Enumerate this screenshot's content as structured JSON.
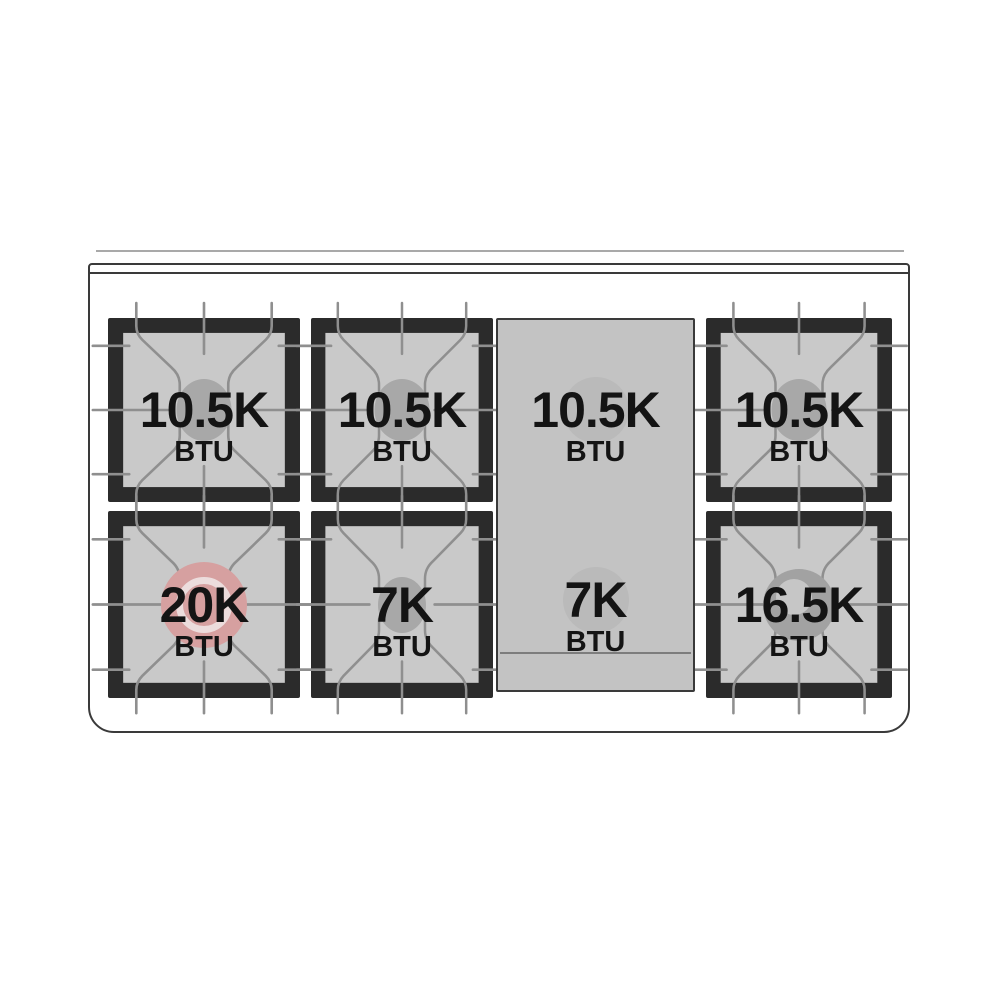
{
  "diagram": {
    "kind": "gas-range-cooktop-burner-layout",
    "unit_label": "BTU"
  },
  "burners": {
    "left_rear": {
      "value": "10.5K",
      "unit": "BTU",
      "style": "standard-cap"
    },
    "center_rear": {
      "value": "10.5K",
      "unit": "BTU",
      "style": "standard-cap"
    },
    "griddle_rear": {
      "value": "10.5K",
      "unit": "BTU",
      "style": "griddle"
    },
    "right_rear": {
      "value": "10.5K",
      "unit": "BTU",
      "style": "standard-cap"
    },
    "left_front": {
      "value": "20K",
      "unit": "BTU",
      "style": "dual-ring-pink"
    },
    "center_front": {
      "value": "7K",
      "unit": "BTU",
      "style": "standard-cap"
    },
    "griddle_front": {
      "value": "7K",
      "unit": "BTU",
      "style": "griddle"
    },
    "right_front": {
      "value": "16.5K",
      "unit": "BTU",
      "style": "ring-gray"
    }
  },
  "colors": {
    "grate_black": "#2b2b2b",
    "grate_plate_gray": "#c9c9c9",
    "griddle_gray": "#c3c3c3",
    "finger_line_gray": "#8f8f8f",
    "cap_gray": "#a8a8a8",
    "dual_ring_pink": "#d6a0a0",
    "ring_gray": "#a2a2a2",
    "frame_outline": "#3a3a3a",
    "text": "#141414",
    "background": "#ffffff"
  }
}
